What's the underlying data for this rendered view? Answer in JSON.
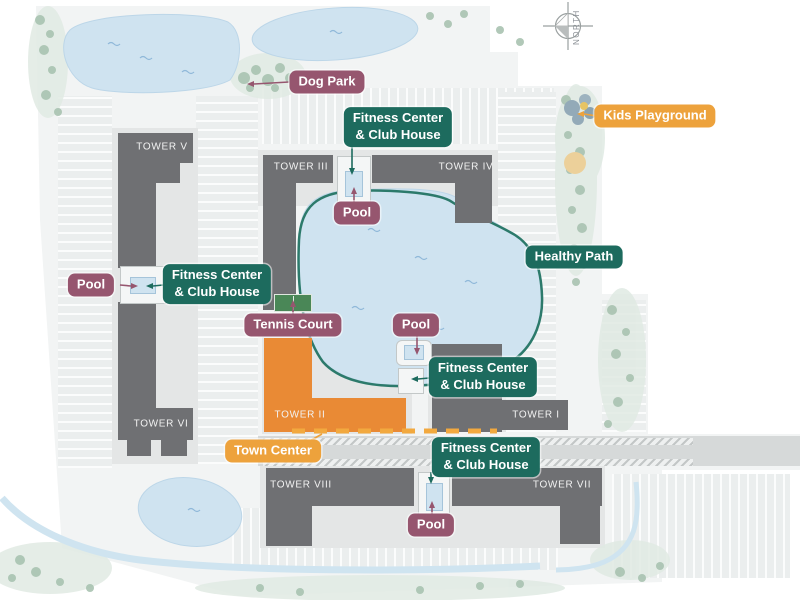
{
  "compass": {
    "label": "NORTH"
  },
  "towers": [
    {
      "id": "tower-v",
      "label": "TOWER V"
    },
    {
      "id": "tower-iii",
      "label": "TOWER III"
    },
    {
      "id": "tower-iv",
      "label": "TOWER IV"
    },
    {
      "id": "tower-vi",
      "label": "TOWER VI"
    },
    {
      "id": "tower-ii",
      "label": "TOWER II"
    },
    {
      "id": "tower-i",
      "label": "TOWER I"
    },
    {
      "id": "tower-viii",
      "label": "TOWER VIII"
    },
    {
      "id": "tower-vii",
      "label": "TOWER VII"
    }
  ],
  "labels": [
    {
      "id": "dog-park",
      "text": "Dog Park",
      "style": "plum"
    },
    {
      "id": "fitness-center-north",
      "text": "Fitness Center\n& Club House",
      "style": "teal"
    },
    {
      "id": "kids-playground",
      "text": "Kids Playground",
      "style": "orange"
    },
    {
      "id": "pool-north",
      "text": "Pool",
      "style": "plum"
    },
    {
      "id": "healthy-path",
      "text": "Healthy Path",
      "style": "teal"
    },
    {
      "id": "pool-west",
      "text": "Pool",
      "style": "plum"
    },
    {
      "id": "fitness-center-west",
      "text": "Fitness Center\n& Club House",
      "style": "teal"
    },
    {
      "id": "tennis-court",
      "text": "Tennis Court",
      "style": "plum"
    },
    {
      "id": "pool-central",
      "text": "Pool",
      "style": "plum"
    },
    {
      "id": "fitness-center-central",
      "text": "Fitness Center\n& Club House",
      "style": "teal"
    },
    {
      "id": "town-center",
      "text": "Town Center",
      "style": "orange"
    },
    {
      "id": "fitness-center-south",
      "text": "Fitness Center\n& Club House",
      "style": "teal"
    },
    {
      "id": "pool-south",
      "text": "Pool",
      "style": "plum"
    }
  ],
  "colors": {
    "label_teal": "#1d6b5e",
    "label_plum": "#96566f",
    "label_orange": "#eda23c",
    "building_gray": "#6f7073",
    "building_orange": "#e98a35",
    "water_blue": "#cfe3f0",
    "path_teal": "#2c7a6b"
  }
}
